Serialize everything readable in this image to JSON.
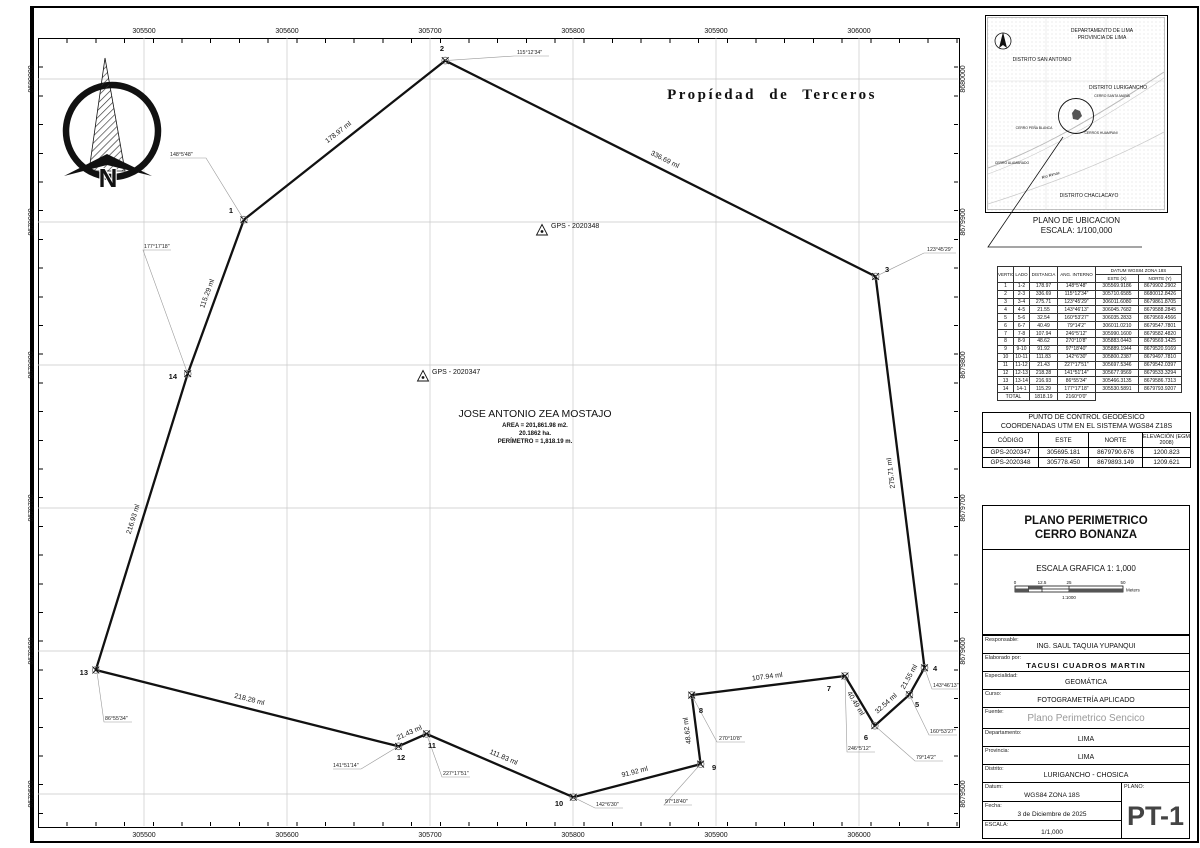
{
  "sheet": {
    "easting_labels": [
      "305500",
      "305600",
      "305700",
      "305800",
      "305900",
      "306000"
    ],
    "northing_labels": [
      "8680000",
      "8679900",
      "8679800",
      "8679700",
      "8679600",
      "8679500"
    ]
  },
  "map": {
    "propiedad_label": "Propíedad de Terceros",
    "north_letter": "N",
    "owner": {
      "name": "JOSE ANTONIO ZEA MOSTAJO",
      "area_m2": "AREA = 201,861.98 m2.",
      "area_ha": "20.1862 ha.",
      "perimeter": "PERÍMETRO = 1,818.19 m."
    },
    "gps_points": {
      "p347": "GPS - 2020347",
      "p348": "GPS - 2020348"
    },
    "vertices": [
      {
        "n": "1",
        "side": "178.97 ml",
        "angle": "148°5'48\""
      },
      {
        "n": "2",
        "side": "336.69 ml",
        "angle": "115°12'34\""
      },
      {
        "n": "3",
        "side": "275.71 ml",
        "angle": "123°45'29\""
      },
      {
        "n": "4",
        "side": "21.55 ml",
        "angle": "143°46'13\""
      },
      {
        "n": "5",
        "side": "32.54 ml",
        "angle": "160°53'27\""
      },
      {
        "n": "6",
        "side": "40.49 ml",
        "angle": "79°14'2\""
      },
      {
        "n": "7",
        "side": "107.94 ml",
        "angle": "246°5'12\""
      },
      {
        "n": "8",
        "side": "48.62 ml",
        "angle": "270°10'8\""
      },
      {
        "n": "9",
        "side": "91.92 ml",
        "angle": "97°18'40\""
      },
      {
        "n": "10",
        "side": "111.83 ml",
        "angle": "142°6'30\""
      },
      {
        "n": "11",
        "side": "21.43 ml",
        "angle": "227°17'51\""
      },
      {
        "n": "12",
        "side": "218.28 ml",
        "angle": "141°51'14\""
      },
      {
        "n": "13",
        "side": "216.93 ml",
        "angle": "86°55'34\""
      },
      {
        "n": "14",
        "side": "115.29 ml",
        "angle": "177°17'18\""
      }
    ]
  },
  "location_map": {
    "departamento": "DEPARTAMENTO DE LIMA",
    "provincia": "PROVINCIA DE LIMA",
    "san_antonio": "DISTRITO SAN ANTONIO",
    "lurigancho": "DISTRITO LURIGANCHO",
    "santa_maria": "CERRO SANTA MARÍA",
    "pena_blanca": "CERRO PEÑA BLANCA",
    "huampani": "CERROS HUAMPANI",
    "alambrado": "CERRO ALAMBRADO",
    "rio": "Río Rimac",
    "chaclacayo": "DISTRITO CHACLACAYO",
    "caption1": "PLANO DE UBICACION",
    "caption2": "ESCALA: 1/100,000"
  },
  "vertex_table": {
    "h_vertice": "VERTICE",
    "h_lado": "LADO",
    "h_distancia": "DISTANCIA",
    "h_ang": "ANG. INTERNO",
    "h_datum": "DATUM WGS84 ZONA 18S",
    "h_este": "ESTE (X)",
    "h_norte": "NORTE (Y)",
    "rows": [
      [
        "1",
        "1-2",
        "178.97",
        "148°5'48\"",
        "305569.9186",
        "8679902.2902"
      ],
      [
        "2",
        "2-3",
        "336.69",
        "115°12'34\"",
        "305710.6585",
        "8680012.8426"
      ],
      [
        "3",
        "3-4",
        "275.71",
        "123°45'29\"",
        "306011.6080",
        "8679861.8705"
      ],
      [
        "4",
        "4-5",
        "21.55",
        "143°46'13\"",
        "306045.7682",
        "8679588.2845"
      ],
      [
        "5",
        "5-6",
        "32.54",
        "160°53'27\"",
        "306035.2833",
        "8679569.4566"
      ],
      [
        "6",
        "6-7",
        "40.49",
        "79°14'2\"",
        "306011.0210",
        "8679547.7801"
      ],
      [
        "7",
        "7-8",
        "107.94",
        "246°5'12\"",
        "305990.1600",
        "8679582.4820"
      ],
      [
        "8",
        "8-9",
        "48.62",
        "270°10'8\"",
        "305883.0443",
        "8679569.1425"
      ],
      [
        "9",
        "9-10",
        "91.92",
        "97°18'40\"",
        "305889.1944",
        "8679520.9169"
      ],
      [
        "10",
        "10-11",
        "111.83",
        "142°6'30\"",
        "305800.2387",
        "8679497.7810"
      ],
      [
        "11",
        "11-12",
        "21.43",
        "227°17'51\"",
        "305697.5346",
        "8679542.0397"
      ],
      [
        "12",
        "12-13",
        "218.28",
        "141°51'14\"",
        "305677.9569",
        "8679533.3294"
      ],
      [
        "13",
        "13-14",
        "216.93",
        "86°55'34\"",
        "305466.3135",
        "8679586.7313"
      ],
      [
        "14",
        "14-1",
        "115.29",
        "177°17'18\"",
        "305530.5891",
        "8679793.9207"
      ]
    ],
    "total_label": "TOTAL",
    "total_dist": "1818.19",
    "total_ang": "2160°0'0\""
  },
  "control_table": {
    "title1": "PUNTO DE CONTROL GEODÉSICO",
    "title2": "COORDENADAS UTM EN EL SISTEMA WGS84 Z18S",
    "headers": [
      "CÓDIGO",
      "ESTE",
      "NORTE",
      "ELEVACIÓN (EGM 2008)"
    ],
    "rows": [
      [
        "GPS-2020347",
        "305695.181",
        "8679790.676",
        "1200.823"
      ],
      [
        "GPS-2020348",
        "305778.450",
        "8679893.149",
        "1209.621"
      ]
    ]
  },
  "title_block": {
    "plan_title_line1": "PLANO PERIMETRICO",
    "plan_title_line2": "CERRO BONANZA",
    "escala_grafica": "ESCALA GRAFICA 1: 1,000",
    "scale_ticks": [
      "0",
      "12.5",
      "25",
      "50"
    ],
    "scale_unit": "Meters",
    "scale_ratio": "1:1000",
    "responsable_label": "Responsable:",
    "responsable": "ING. SAUL TAQUIA YUPANQUI",
    "elaborado_label": "Elaborado por:",
    "elaborado": "TACUSI  CUADROS  MARTIN",
    "especialidad_label": "Especialidad:",
    "especialidad": "GEOMÁTICA",
    "curso_label": "Curso:",
    "curso": "FOTOGRAMETRÍA APLICADO",
    "fuente_label": "Fuente:",
    "fuente": "Plano Perimetrico Sencico",
    "departamento_label": "Departamento:",
    "departamento": "LIMA",
    "provincia_label": "Provincia:",
    "provincia": "LIMA",
    "distrito_label": "Distrito:",
    "distrito": "LURIGANCHO - CHOSICA",
    "datum_label": "Datum:",
    "datum": "WGS84 ZONA 18S",
    "fecha_label": "Fecha:",
    "fecha": "3 de Diciembre de 2025",
    "escala_label": "ESCALA:",
    "escala": "1/1,000",
    "plano_label": "PLANO:",
    "plano_code": "PT-1"
  },
  "colors": {
    "line": "#111111",
    "grid": "#c9c9c9",
    "leader": "#999999",
    "gray_text": "#9a9a9a"
  }
}
